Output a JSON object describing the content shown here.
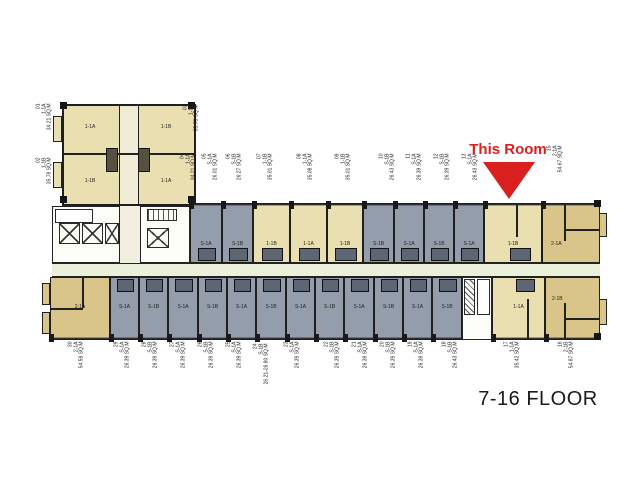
{
  "title": "7-16 FLOOR",
  "annotation": {
    "text": "This Room"
  },
  "colors": {
    "unit_tan": "#eadfb0",
    "unit_tan_dark": "#d9c489",
    "unit_gray": "#949dac",
    "corridor": "#eaf0da",
    "wall": "#1f1f1f",
    "accent_red": "#d8201f"
  },
  "nw_block": [
    {
      "no": "01",
      "type": "1-1A",
      "area": "34.21 SQ.M"
    },
    {
      "no": "02",
      "type": "1-1B",
      "area": "35.78 SQ.M"
    },
    {
      "no": "03",
      "type": "1-1B",
      "area": "35.78 SQ.M"
    },
    {
      "no": "04",
      "type": "1-1A",
      "area": "34.21 SQ.M"
    }
  ],
  "top_band": [
    {
      "no": "05",
      "type": "S-1A",
      "area": "26.01 SQ.M"
    },
    {
      "no": "06",
      "type": "S-1B",
      "area": "26.27 SQ.M"
    },
    {
      "no": "07",
      "type": "1-1B",
      "area": "35.01 SQ.M"
    },
    {
      "no": "08",
      "type": "1-1A",
      "area": "35.08 SQ.M"
    },
    {
      "no": "09",
      "type": "1-1B",
      "area": "35.01 SQ.M"
    },
    {
      "no": "10",
      "type": "S-1B",
      "area": "26.43 SQ.M"
    },
    {
      "no": "11",
      "type": "S-1A",
      "area": "26.39 SQ.M"
    },
    {
      "no": "12",
      "type": "S-1B",
      "area": "26.39 SQ.M"
    },
    {
      "no": "13",
      "type": "S-1A",
      "area": "26.43 SQ.M"
    },
    {
      "no": "14",
      "type": "1-1B",
      "area": ""
    },
    {
      "no": "15",
      "type": "2-1A",
      "area": "54.67 SQ.M"
    }
  ],
  "bottom_band": [
    {
      "no": "16",
      "type": "2-1B",
      "area": "54.87 SQ.M"
    },
    {
      "no": "17",
      "type": "1-1A",
      "area": "35.42 SQ.M"
    },
    {
      "no": "18",
      "type": "S-1B",
      "area": "26.43 SQ.M"
    },
    {
      "no": "19",
      "type": "S-1A",
      "area": "26.39 SQ.M"
    },
    {
      "no": "20",
      "type": "S-1B",
      "area": "26.39 SQ.M"
    },
    {
      "no": "21",
      "type": "S-1A",
      "area": "26.39 SQ.M"
    },
    {
      "no": "22",
      "type": "S-1B",
      "area": "26.39 SQ.M"
    },
    {
      "no": "23",
      "type": "S-1A",
      "area": "26.39 SQ.M"
    },
    {
      "no": "24",
      "type": "S-1B",
      "area": "26.21-26.80 SQ.M"
    },
    {
      "no": "25",
      "type": "S-1A",
      "area": "26.39 SQ.M"
    },
    {
      "no": "26",
      "type": "S-1B",
      "area": "26.39 SQ.M"
    },
    {
      "no": "27",
      "type": "S-1A",
      "area": "26.39 SQ.M"
    },
    {
      "no": "28",
      "type": "S-1B",
      "area": "26.39 SQ.M"
    },
    {
      "no": "29",
      "type": "S-1A",
      "area": "26.39 SQ.M"
    },
    {
      "no": "30",
      "type": "2-1A",
      "area": "54.59 SQ.M"
    }
  ]
}
